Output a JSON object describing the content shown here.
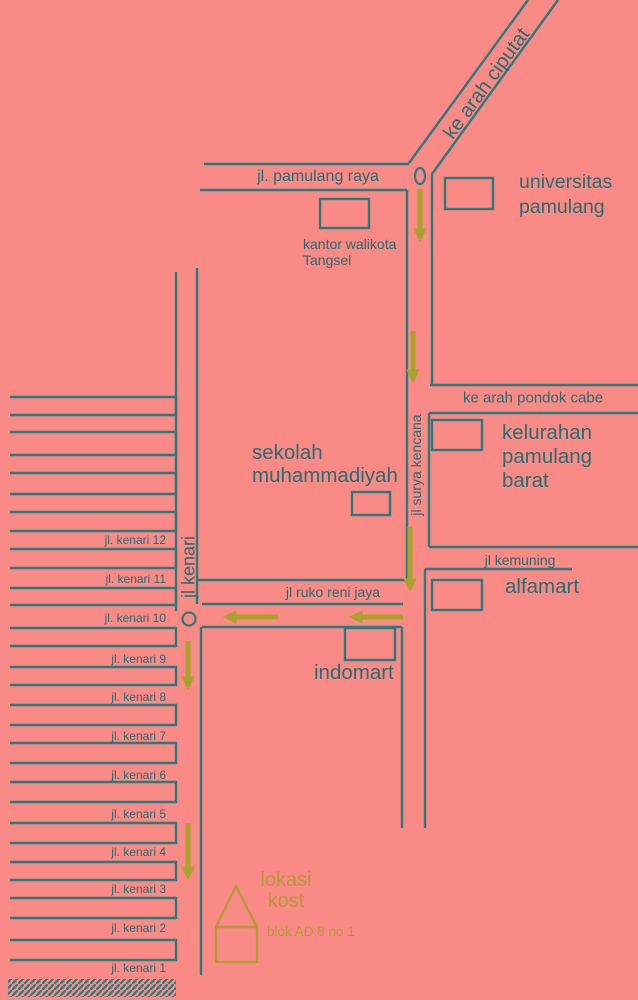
{
  "map_title": "denah lokasi kost",
  "roads": {
    "ciputat": "ke arah ciputat",
    "pamulang_raya": "jl. pamulang raya",
    "surya_kencana": "jl surya kencana",
    "pondok_cabe": "ke arah pondok cabe",
    "kemuning": "jl kemuning",
    "ruko_reni_jaya": "jl ruko reni jaya",
    "kenari": "jl kenari"
  },
  "places": {
    "universitas": "universitas\npamulang",
    "kantor_walikota": "kantor walikota\nTangsel",
    "sekolah": "sekolah\nmuhammadiyah",
    "kelurahan": "kelurahan\npamulang barat",
    "alfamart": "alfamart",
    "indomart": "indomart"
  },
  "destination": {
    "label": "lokasi\nkost",
    "detail": "blok AD 8 no 1"
  },
  "left_streets": {
    "labels": [
      "jl. kenari 12",
      "jl. kenari 11",
      "jl. kenari 10",
      "jl. kenari 9",
      "jl. kenari 8",
      "jl. kenari 7",
      "jl. kenari 6",
      "jl. kenari 5",
      "jl. kenari 4",
      "jl. kenari 3",
      "jl. kenari 2",
      "jl. kenari 1"
    ]
  },
  "colors": {
    "background": "#f98a85",
    "road_line": "#2b7b7e",
    "label_text": "#266e72",
    "route_arrow": "#a9a22b",
    "destination_accent": "#b8993a"
  }
}
